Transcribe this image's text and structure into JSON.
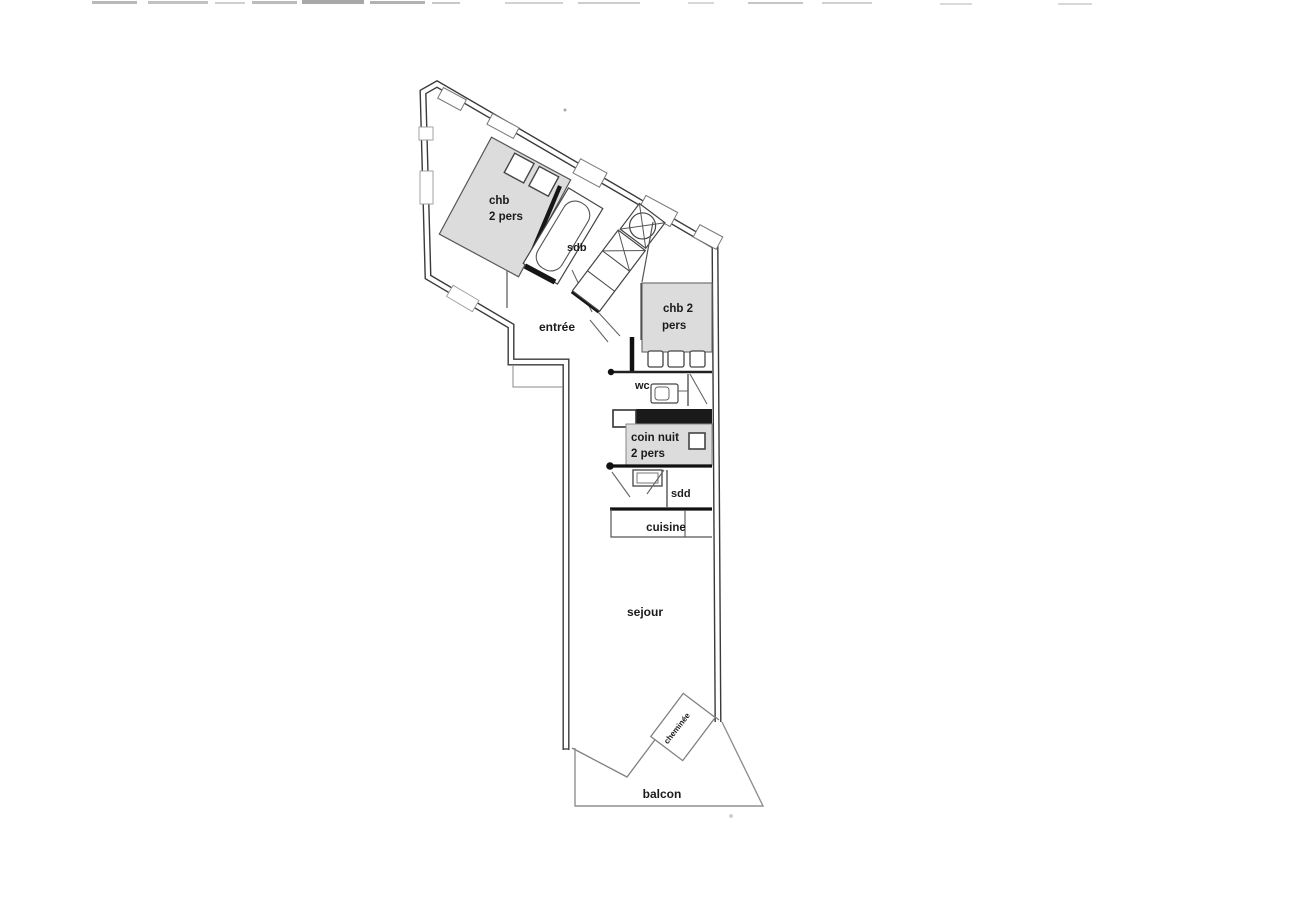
{
  "plan": {
    "rooms": {
      "bedroom1": {
        "line1": "chb",
        "line2": "2 pers"
      },
      "bathroom": {
        "label": "sdb"
      },
      "entrance": {
        "label": "entrée"
      },
      "bedroom2": {
        "line1": "chb 2",
        "line2": "pers"
      },
      "wc": {
        "label": "wc"
      },
      "sleeping_nook": {
        "line1": "coin nuit",
        "line2": "2 pers"
      },
      "shower_room": {
        "label": "sdd"
      },
      "kitchen": {
        "label": "cuisine"
      },
      "living_room": {
        "label": "sejour"
      },
      "fireplace": {
        "label": "cheminée"
      },
      "balcony": {
        "label": "balcon"
      }
    },
    "colors": {
      "background": "#ffffff",
      "wall": "#3a3a3a",
      "dark_wall": "#161616",
      "furniture_fill": "#dcdcdc",
      "thin_line": "#808080",
      "text": "#1b1b1b"
    }
  }
}
